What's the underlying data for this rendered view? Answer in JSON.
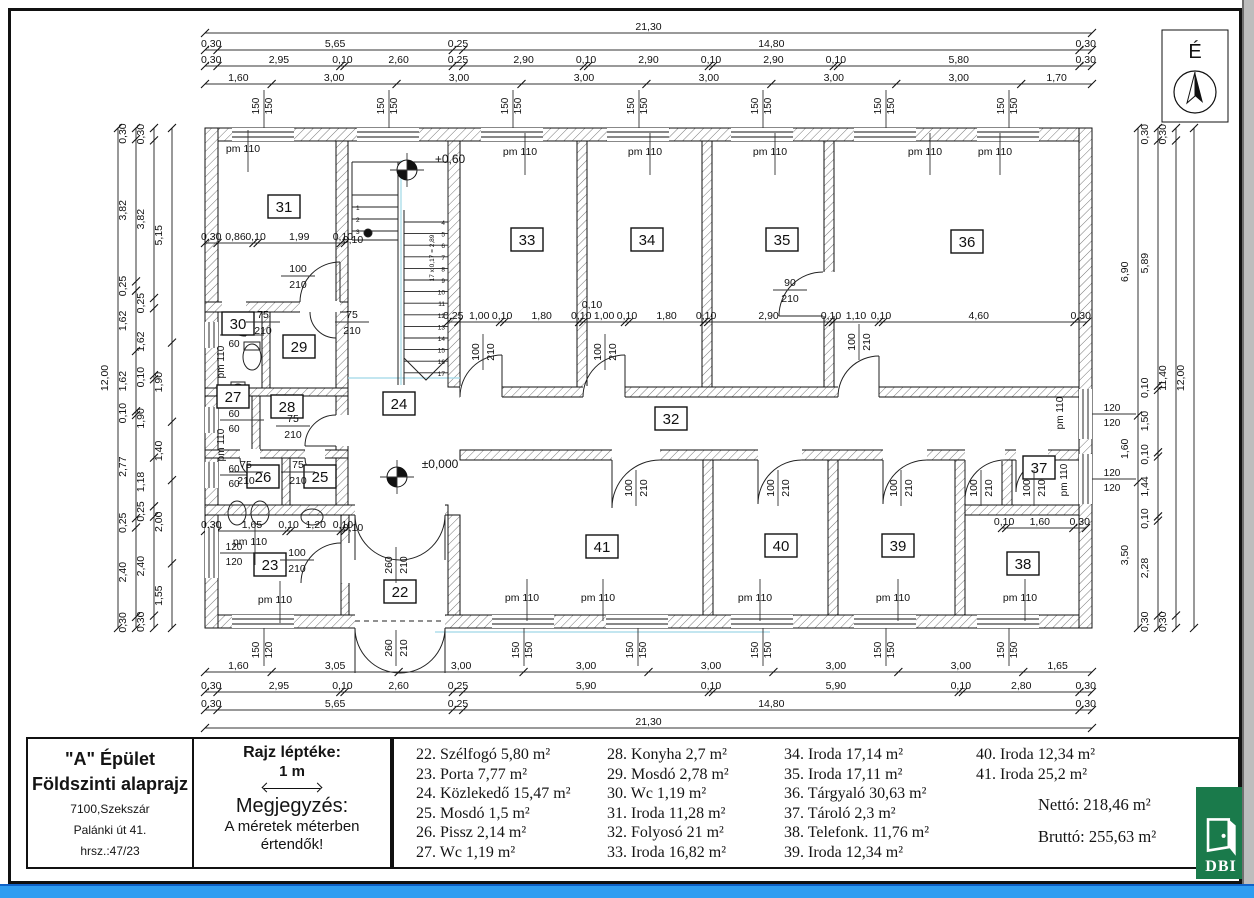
{
  "compass": {
    "label": "É"
  },
  "title_block": {
    "building": "\"A\" Épület",
    "drawing": "Földszinti alaprajz",
    "address1": "7100,Szekszár",
    "address2": "Palánki út 41.",
    "address3": "hrsz.:47/23"
  },
  "scale_block": {
    "title": "Rajz léptéke:",
    "value": "1 m",
    "note_title": "Megjegyzés:",
    "note1": "A méretek méterben",
    "note2": "értendők!"
  },
  "legend": {
    "col1": [
      "22. Szélfogó 5,80 m²",
      "23. Porta 7,77 m²",
      "24. Közlekedő 15,47 m²",
      "25. Mosdó 1,5 m²",
      "26. Pissz 2,14 m²",
      "27. Wc 1,19 m²"
    ],
    "col2": [
      "28. Konyha 2,7 m²",
      "29. Mosdó 2,78 m²",
      "30. Wc 1,19 m²",
      "31. Iroda 11,28 m²",
      "32. Folyosó 21 m²",
      "33. Iroda 16,82 m²"
    ],
    "col3": [
      "34. Iroda 17,14 m²",
      "35. Iroda 17,11 m²",
      "36. Tárgyaló 30,63 m²",
      "37. Tároló 2,3 m²",
      "38. Telefonk. 11,76 m²",
      "39. Iroda 12,34 m²"
    ],
    "col4": [
      "40. Iroda 12,34 m²",
      "41. Iroda 25,2 m²"
    ]
  },
  "totals": {
    "netto_label": "Nettó:",
    "netto_value": "218,46 m²",
    "brutto_label": "Bruttó:",
    "brutto_value": "255,63 m²"
  },
  "logo": {
    "text": "DBI"
  },
  "rooms": [
    "22",
    "23",
    "24",
    "25",
    "26",
    "27",
    "28",
    "29",
    "30",
    "31",
    "32",
    "33",
    "34",
    "35",
    "36",
    "37",
    "38",
    "39",
    "40",
    "41"
  ],
  "plan_labels": {
    "pm": "pm 110",
    "levels": [
      "+0,60",
      "±0,000"
    ],
    "stair_note": "17 x 0,17 = 2,89",
    "stair_numbers": [
      "1",
      "2",
      "3",
      "4",
      "5",
      "6",
      "7",
      "8",
      "9",
      "10",
      "11",
      "12",
      "13",
      "14",
      "15",
      "16",
      "17"
    ]
  },
  "doors": [
    {
      "w": "100",
      "h": "210"
    },
    {
      "w": "75",
      "h": "210"
    },
    {
      "w": "75",
      "h": "210"
    },
    {
      "w": "75",
      "h": "210"
    },
    {
      "w": "75",
      "h": "210"
    },
    {
      "w": "75",
      "h": "210"
    },
    {
      "w": "100",
      "h": "210"
    },
    {
      "w": "90",
      "h": "210"
    },
    {
      "w": "100",
      "h": "210"
    },
    {
      "w": "100",
      "h": "210"
    },
    {
      "w": "100",
      "h": "210"
    },
    {
      "w": "100",
      "h": "210"
    },
    {
      "w": "100",
      "h": "210"
    },
    {
      "w": "100",
      "h": "210"
    },
    {
      "w": "100",
      "h": "210"
    },
    {
      "w": "100",
      "h": "210"
    },
    {
      "w": "260",
      "h": "210"
    },
    {
      "w": "260",
      "h": "210"
    }
  ],
  "dims": {
    "top": [
      [
        "21,30"
      ],
      [
        "0,30",
        "5,65",
        "0,25",
        "14,80",
        "0,30"
      ],
      [
        "0,30",
        "2,95",
        "0,10",
        "2,60",
        "0,25",
        "2,90",
        "0,10",
        "2,90",
        "0,10",
        "2,90",
        "0,10",
        "5,80",
        "0,30"
      ],
      [
        "1,60",
        "3,00",
        "3,00",
        "3,00",
        "3,00",
        "3,00",
        "3,00",
        "1,70"
      ]
    ],
    "bottom": [
      [
        "1,60",
        "3,05",
        "3,00",
        "3,00",
        "3,00",
        "3,00",
        "3,00",
        "1,65"
      ],
      [
        "0,30",
        "2,95",
        "0,10",
        "2,60",
        "0,25",
        "5,90",
        "0,10",
        "5,90",
        "0,10",
        "2,80",
        "0,30"
      ],
      [
        "0,30",
        "5,65",
        "0,25",
        "14,80",
        "0,30"
      ],
      [
        "21,30"
      ]
    ],
    "left": [
      [
        "12,00"
      ],
      [
        "0,30",
        "3,82",
        "0,25",
        "1,62",
        "1,62",
        "0,10",
        "2,77",
        "0,25",
        "2,40",
        "0,30"
      ],
      [
        "0,30",
        "3,82",
        "0,25",
        "1,62",
        "0,10",
        "1,90",
        "1,18",
        "0,25",
        "2,40",
        "0,30"
      ],
      [
        "5,15",
        "1,90",
        "1,40",
        "2,00",
        "1,55"
      ]
    ],
    "right": [
      [
        "6,90",
        "1,60",
        "3,50"
      ],
      [
        "0,30",
        "5,89",
        "0,10",
        "1,50",
        "0,10",
        "1,44",
        "0,10",
        "2,28",
        "0,30"
      ],
      [
        "0,30",
        "11,40",
        "0,30"
      ],
      [
        "12,00"
      ]
    ],
    "inner_top_rooms": [
      "0,25",
      "1,00",
      "0,10",
      "1,80",
      "0,10",
      "1,00",
      "0,10",
      "1,80",
      "0,10",
      "2,90",
      "0,10",
      "1,10",
      "0,10",
      "4,60",
      "0,30"
    ],
    "room31": [
      "0,30",
      "0,86",
      "0,10",
      "1,99",
      "0,10"
    ],
    "room23": [
      "0,30",
      "1,65",
      "0,10",
      "1,20",
      "0,10"
    ],
    "room37": [
      "0,10",
      "1,60",
      "0,30"
    ],
    "extras": [
      "0,10",
      "0,10",
      "0,10"
    ],
    "window_pairs_top": [
      [
        "150",
        "150"
      ],
      [
        "150",
        "150"
      ],
      [
        "150",
        "150"
      ],
      [
        "150",
        "150"
      ],
      [
        "150",
        "150"
      ],
      [
        "150",
        "150"
      ],
      [
        "150",
        "150"
      ]
    ],
    "window_pairs_bottom": [
      [
        "150",
        "120"
      ],
      [
        "150",
        "150"
      ],
      [
        "150",
        "150"
      ],
      [
        "150",
        "150"
      ],
      [
        "150",
        "150"
      ],
      [
        "150",
        "150"
      ]
    ],
    "window_pairs_left": [
      [
        "60",
        "60"
      ],
      [
        "60",
        "60"
      ],
      [
        "60",
        "60"
      ],
      [
        "120",
        "120"
      ]
    ],
    "window_pairs_right": [
      [
        "120",
        "120"
      ],
      [
        "120",
        "120"
      ]
    ]
  }
}
